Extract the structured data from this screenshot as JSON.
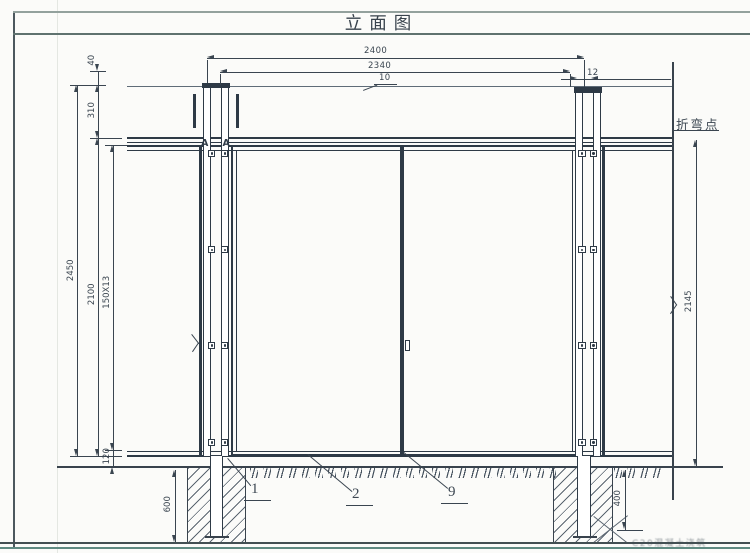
{
  "sheet": {
    "title": "立面图",
    "note": "C20混凝土浇筑"
  },
  "dimensions": {
    "top_outer": "2400",
    "top_inner": "2340",
    "mesh_wire": "10",
    "post_width": "12",
    "left_offset_top": "40",
    "left_bend_height": "310",
    "left_total_height": "2450",
    "left_panel_height": "2100",
    "mesh_cells": "150X13",
    "left_bottom_gap": "120",
    "foundation_depth": "600",
    "right_bend_to_ground": "2145",
    "post_embed": "400"
  },
  "callouts": {
    "bend_point": "折弯点",
    "section": "A",
    "part_1": "1",
    "part_2": "2",
    "part_9": "9"
  },
  "colors": {
    "line": "#2e3a46",
    "dim": "#3a4550",
    "mesh": "#adb8c6",
    "border_teal": "#5f8a82"
  }
}
